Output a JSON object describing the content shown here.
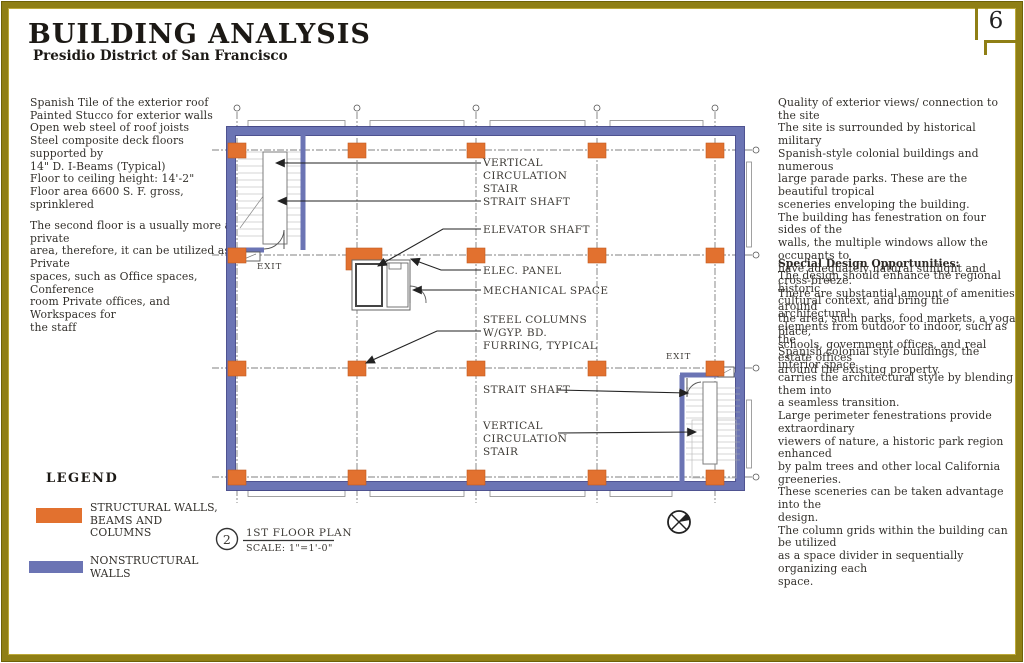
{
  "page_number": "6",
  "header": {
    "title": "BUILDING ANALYSIS",
    "subtitle": "Presidio District of San Francisco"
  },
  "left_panel": {
    "specs": "Spanish Tile of the exterior roof\nPainted Stucco for exterior walls\nOpen web steel of roof joists\nSteel composite deck floors supported by\n14\" D. I-Beams (Typical)\nFloor to ceiling height: 14'-2\"\nFloor area 6600 S. F. gross, sprinklered",
    "note": "The second floor is a usually more a private\narea, therefore, it can be utilized as Private\nspaces, such as Office spaces, Conference\nroom Private offices, and Workspaces for\nthe staff"
  },
  "legend": {
    "title": "LEGEND",
    "items": [
      {
        "label": "STRUCTURAL WALLS,\nBEAMS AND COLUMNS",
        "color": "#e2712f"
      },
      {
        "label": "NONSTRUCTURAL\nWALLS",
        "color": "#6b74b4"
      }
    ]
  },
  "right_panel": {
    "intro": "Quality of exterior views/ connection to the site\nThe site is surrounded by historical military\nSpanish-style colonial buildings and numerous\nlarge parade parks. These are the beautiful tropical\nsceneries enveloping the building.\n The building has fenestration on four sides of the\nwalls, the multiple windows allow the occupants to\nhave adequately natural sunlight and cross-breeze.\nThere are substantial amount of amenities around\nthe area, such parks, food markets, a yoga place,\nschools, government offices, and real estate offices\naround the existing property.",
    "heading": "Special Design Opportunities:",
    "body": "The design should enhance the regional historic\ncultural context, and bring the architectural\nelements from outdoor to indoor, such as the\nSpanish colonial style buildings, the interior space\ncarries the architectural style by blending them into\na seamless transition.\nLarge perimeter fenestrations provide extraordinary\nviewers of nature, a historic park region enhanced\nby palm trees and other local California greeneries.\nThese sceneries can be taken advantage into the\ndesign.\nThe column grids within the building can be utilized\nas a space divider in sequentially organizing each\nspace."
  },
  "plan": {
    "labels": {
      "vcs1": [
        "VERTICAL",
        "CIRCULATION",
        "STAIR"
      ],
      "strait1": "STRAIT SHAFT",
      "elevator": "ELEVATOR SHAFT",
      "elec": "ELEC. PANEL",
      "mech": "MECHANICAL SPACE",
      "steel": [
        "STEEL COLUMNS",
        "W/GYP. BD.",
        "FURRING, TYPICAL"
      ],
      "strait2": "STRAIT SHAFT",
      "vcs2": [
        "VERTICAL",
        "CIRCULATION",
        "STAIR"
      ],
      "exit1": "EXIT",
      "exit2": "EXIT"
    },
    "callout": {
      "number": "2",
      "title": "1ST FLOOR PLAN",
      "scale": "SCALE: 1\"=1'-0\""
    }
  },
  "colors": {
    "structural_orange": "#e2712f",
    "nonstructural_blue": "#6b74b4",
    "frame_olive": "#8f7f15"
  }
}
